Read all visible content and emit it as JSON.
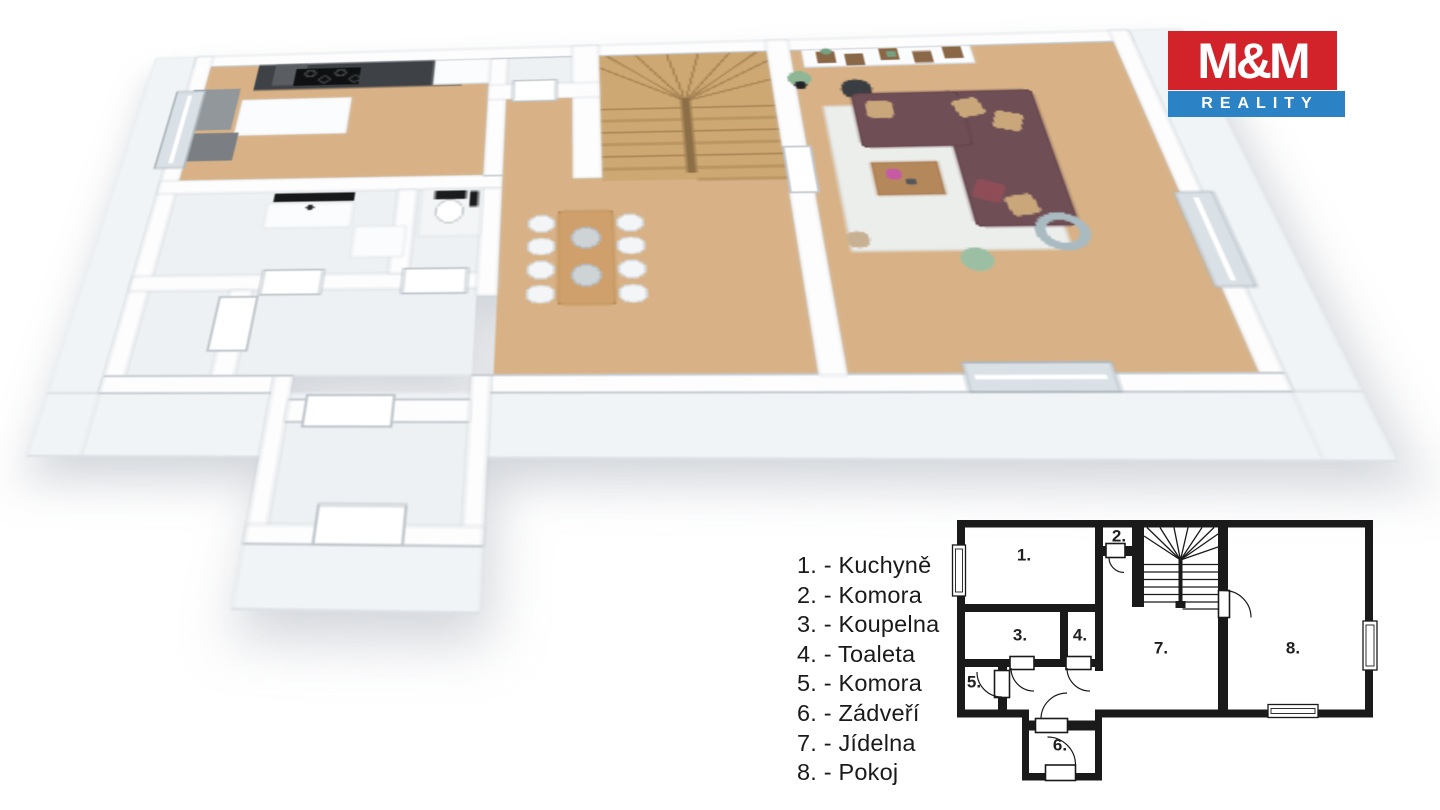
{
  "brand": {
    "name_top": "M&M",
    "name_bottom": "REALITY"
  },
  "colors": {
    "brand-red": "#d2232a",
    "brand-blue": "#2b82c4",
    "plan-ink": "#1a1a1a",
    "text": "#1a1a1a",
    "wood": "#d8b286",
    "tile": "#eef1f3",
    "wall-line": "#c6ccd2",
    "glass": "#dae1e6",
    "counter": "#3e4246",
    "sofa": "#6f4e55",
    "rug": "#eceeec"
  },
  "legend": {
    "items": [
      {
        "num": "1.",
        "name": "Kuchyně",
        "label": "1. - Kuchyně"
      },
      {
        "num": "2.",
        "name": "Komora",
        "label": "2. - Komora"
      },
      {
        "num": "3.",
        "name": "Koupelna",
        "label": "3. - Koupelna"
      },
      {
        "num": "4.",
        "name": "Toaleta",
        "label": "4. - Toaleta"
      },
      {
        "num": "5.",
        "name": "Komora",
        "label": "5. - Komora"
      },
      {
        "num": "6.",
        "name": "Zádveří",
        "label": "6. - Zádveří"
      },
      {
        "num": "7.",
        "name": "Jídelna",
        "label": "7. - Jídelna"
      },
      {
        "num": "8.",
        "name": "Pokoj",
        "label": "8. - Pokoj"
      }
    ]
  }
}
